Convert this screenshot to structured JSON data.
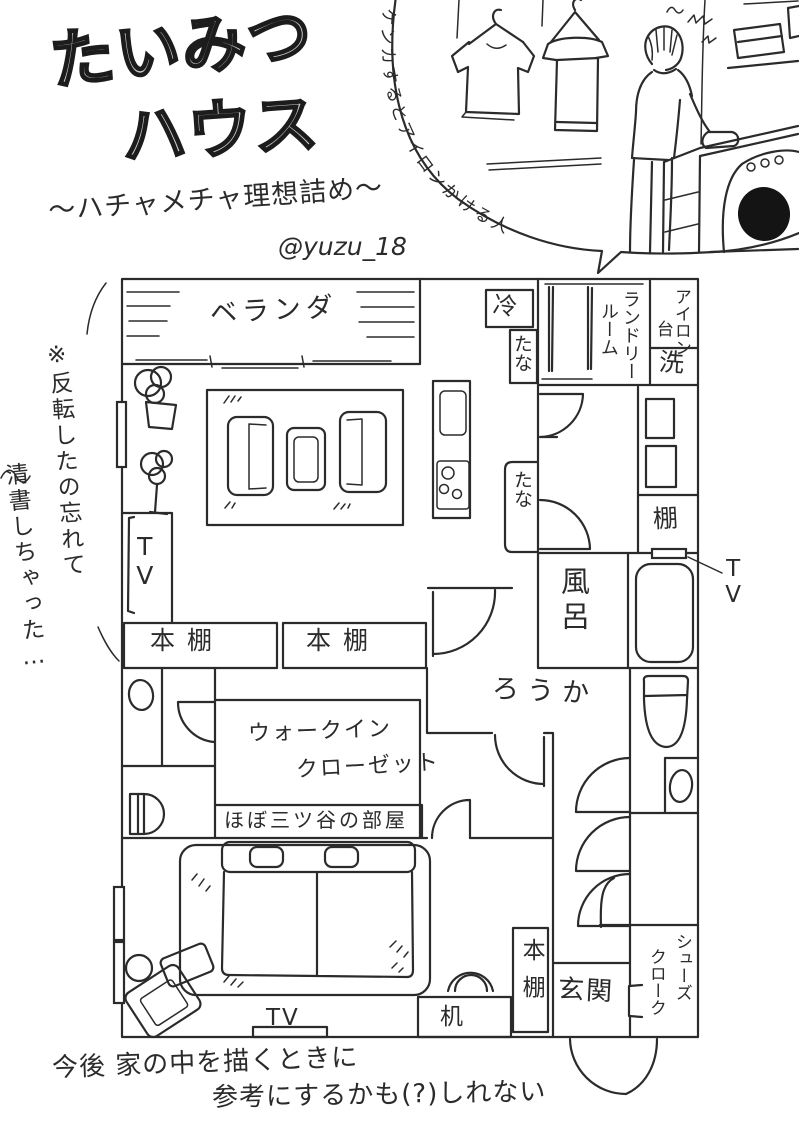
{
  "artwork": {
    "title_line1": "たいみつ",
    "title_line2": "ハウス",
    "subtitle": "〜ハチャメチャ理想詰め〜",
    "handle": "@yuzu_18",
    "bubble_caption": "ケンカするとアイロンかける人",
    "side_note_line1": "※反転したの忘れて",
    "side_note_line2": "清書しちゃった…",
    "bottom_note_line1": "今後 家の中を描くときに",
    "bottom_note_line2": "参考にするかも(?)しれない"
  },
  "floor_plan": {
    "balcony": "ベランダ",
    "refrigerator": "冷",
    "shelf_upper": "たな",
    "shelf_lower": "たな",
    "laundry_room_line1": "ランドリー",
    "laundry_room_line2": "ルーム",
    "ironing_board_line1": "アイロン",
    "ironing_board_line2": "台",
    "washing_machine": "洗",
    "shelf_kanji": "棚",
    "bath": "風呂",
    "tv_bath": "TV",
    "tv_living": "TV",
    "tv_bedroom": "TV",
    "bookshelf_left": "本棚",
    "bookshelf_right": "本棚",
    "bookshelf_bedroom": "本棚",
    "hallway": "ろうか",
    "walk_in_closet_line1": "ウォークイン",
    "walk_in_closet_line2": "クローゼット",
    "room_note": "ほぼ三ツ谷の部屋",
    "desk": "机",
    "entrance": "玄関",
    "shoe_closet_line1": "シューズ",
    "shoe_closet_line2": "クローク"
  },
  "colors": {
    "ink": "#2b2b2b",
    "title_fill": "#c9c9c9",
    "background": "#ffffff"
  }
}
